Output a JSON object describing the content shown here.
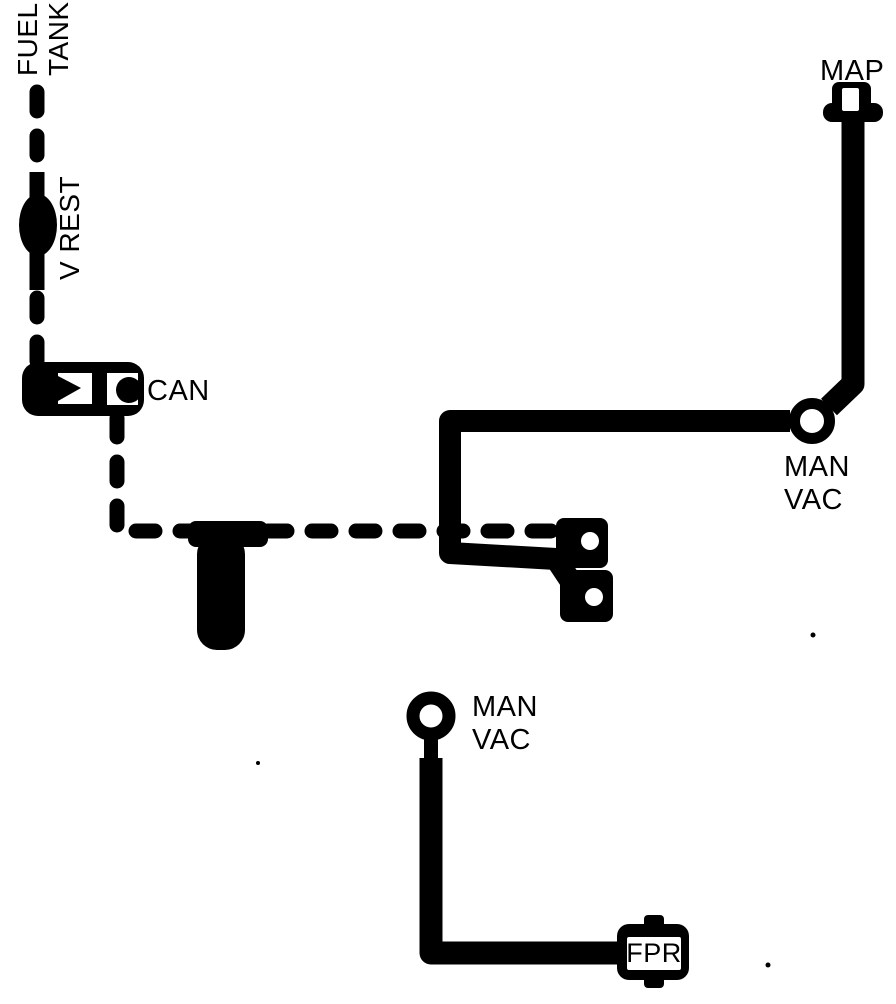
{
  "colors": {
    "ink": "#000000",
    "paper": "#ffffff"
  },
  "labels": {
    "fuel_tank": {
      "line1": "FUEL",
      "line2": "TANK"
    },
    "v_rest": "V REST",
    "canister": "CAN",
    "map": "MAP",
    "man_vac_right": {
      "line1": "MAN",
      "line2": "VAC"
    },
    "man_vac_center": {
      "line1": "MAN",
      "line2": "VAC"
    },
    "fpr": "FPR"
  },
  "diagram": {
    "type": "vacuum-hose-routing-schematic",
    "nodes": [
      {
        "id": "fuel-tank",
        "label": "FUEL TANK",
        "kind": "source"
      },
      {
        "id": "v-rest",
        "label": "V REST",
        "kind": "inline-valve"
      },
      {
        "id": "can",
        "label": "CAN",
        "kind": "vapor-canister"
      },
      {
        "id": "tee-junction",
        "label": "",
        "kind": "tee-fitting"
      },
      {
        "id": "throttle-ports",
        "label": "",
        "kind": "dual-port-fitting"
      },
      {
        "id": "map",
        "label": "MAP",
        "kind": "sensor-port"
      },
      {
        "id": "man-vac-right",
        "label": "MAN VAC",
        "kind": "manifold-vacuum-port"
      },
      {
        "id": "man-vac-center",
        "label": "MAN VAC",
        "kind": "manifold-vacuum-port"
      },
      {
        "id": "fpr",
        "label": "FPR",
        "kind": "fuel-pressure-regulator"
      }
    ],
    "connections": [
      {
        "from": "fuel-tank",
        "to": "v-rest",
        "style": "dashed"
      },
      {
        "from": "v-rest",
        "to": "can",
        "style": "dashed"
      },
      {
        "from": "can",
        "to": "tee-junction",
        "style": "dashed"
      },
      {
        "from": "tee-junction",
        "to": "throttle-ports",
        "style": "dashed"
      },
      {
        "from": "map",
        "to": "man-vac-right",
        "style": "solid"
      },
      {
        "from": "man-vac-right",
        "to": "throttle-ports",
        "style": "solid"
      },
      {
        "from": "man-vac-center",
        "to": "fpr",
        "style": "solid"
      }
    ]
  }
}
